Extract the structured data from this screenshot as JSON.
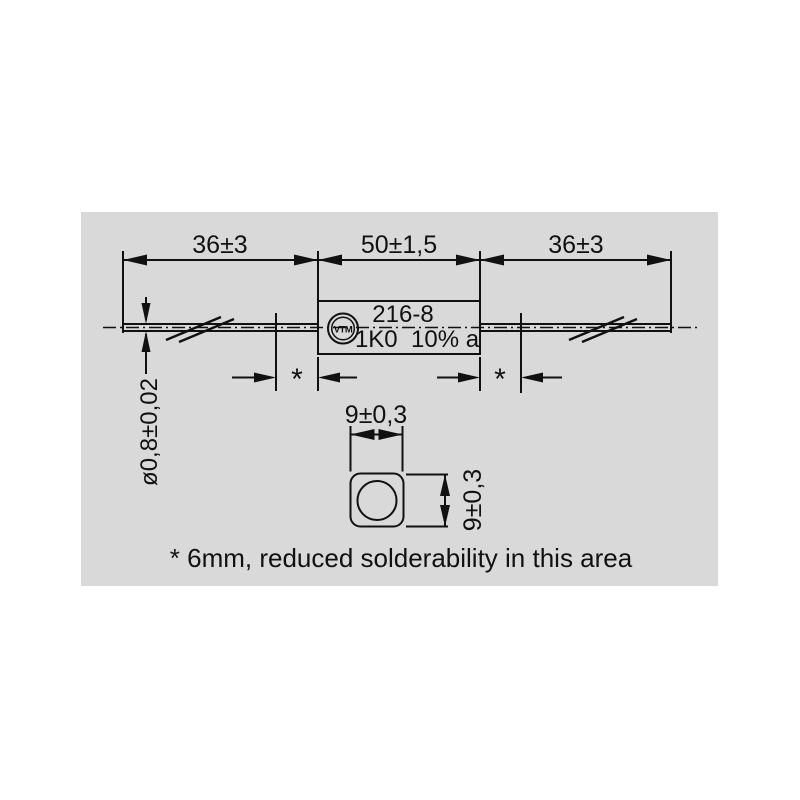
{
  "drawing": {
    "top_dimensions": {
      "left_lead": "36±3",
      "body_length": "50±1,5",
      "right_lead": "36±3"
    },
    "wire_diameter_label": "ø0,8±0,02",
    "resistor_marking": {
      "logo": "VTM",
      "line1": "216-8",
      "line2": "1K0  10% a"
    },
    "solder_zone_marker": "*",
    "cross_section": {
      "width_label": "9±0,3",
      "height_label": "9±0,3"
    },
    "footnote": "* 6mm, reduced solderability in this area"
  },
  "colors": {
    "panel_bg": "#d9d9d9",
    "body_fill": "#ffffff"
  }
}
